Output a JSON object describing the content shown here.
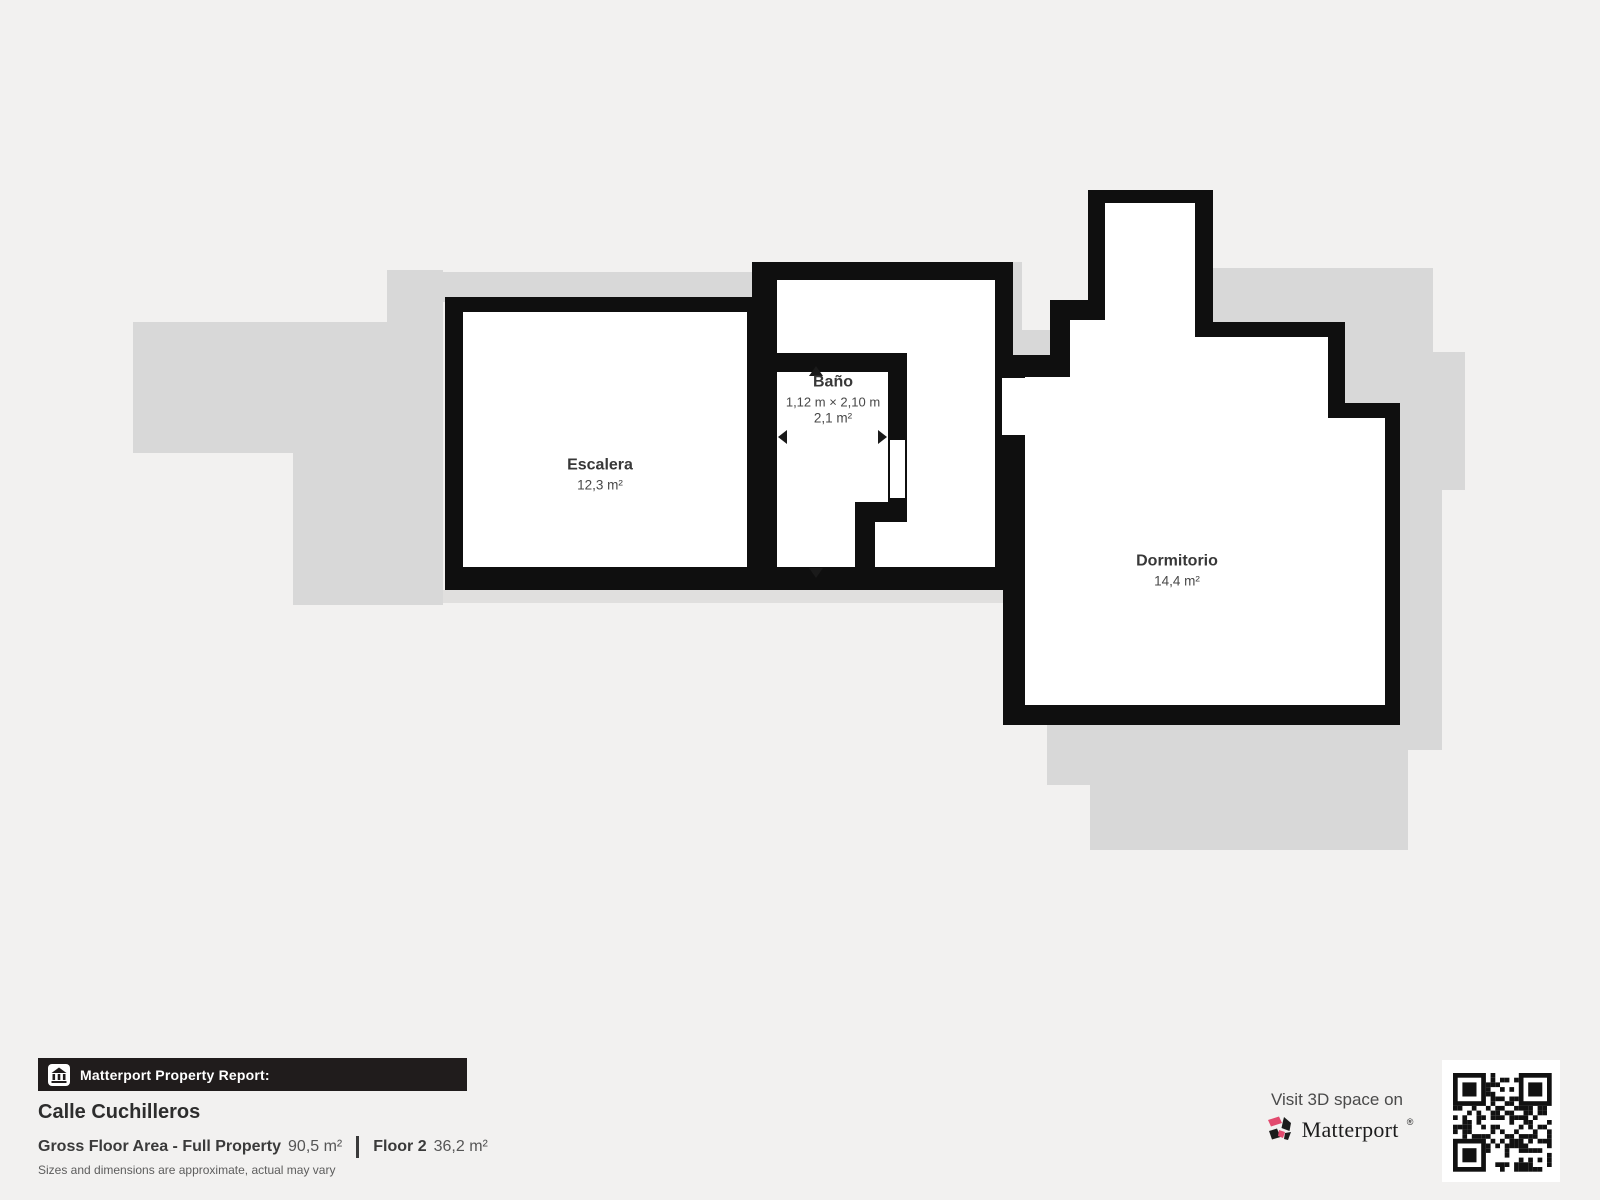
{
  "plan": {
    "rooms": [
      {
        "name": "Escalera",
        "area": "12,3 m²"
      },
      {
        "name": "Baño",
        "dimensions": "1,12 m × 2,10 m",
        "area": "2,1 m²"
      },
      {
        "name": "Dormitorio",
        "area": "14,4 m²"
      }
    ],
    "icons": [
      "dimension-arrow-up",
      "dimension-arrow-down",
      "dimension-arrow-left",
      "dimension-arrow-right"
    ]
  },
  "footer": {
    "report_label": "Matterport Property Report:",
    "property_name": "Calle Cuchilleros",
    "gross_label": "Gross Floor Area - Full Property",
    "gross_value": "90,5 m²",
    "floor_label": "Floor 2",
    "floor_value": "36,2 m²",
    "disclaimer": "Sizes and dimensions are approximate, actual may vary"
  },
  "promo": {
    "visit_text": "Visit 3D space on",
    "brand": "Matterport",
    "trademark": "®",
    "qr_icon": "qr-code"
  },
  "colors": {
    "background": "#f2f1f0",
    "underlay_gray": "#d8d8d8",
    "wall_black": "#0f0f0f",
    "banner_black": "#201c1c",
    "brand_pink": "#e24a6e",
    "text_dark": "#3a3a3a"
  }
}
